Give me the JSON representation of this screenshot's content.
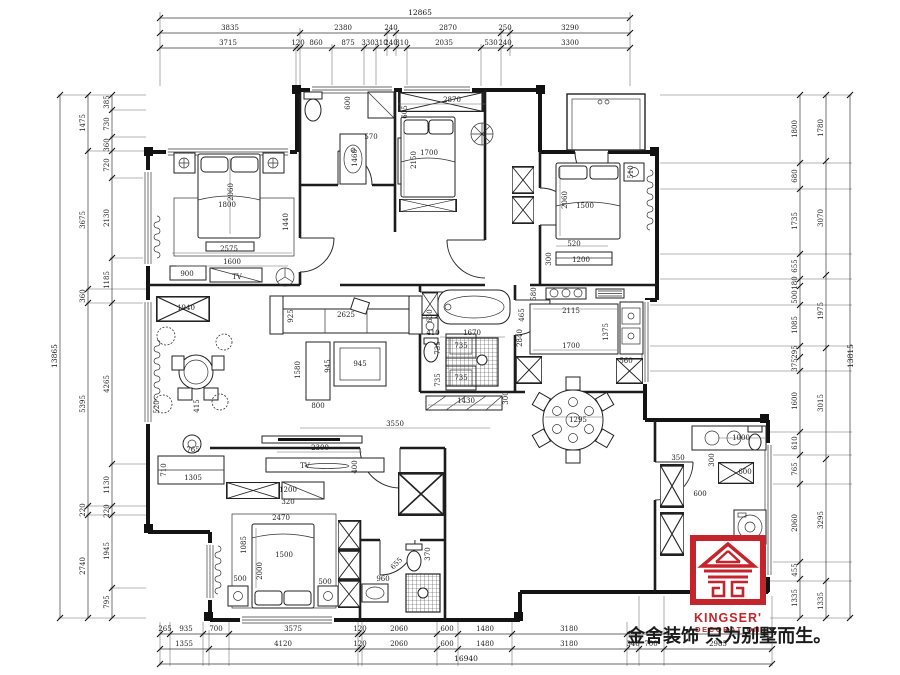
{
  "branding": {
    "logo_top": "KINGSER'",
    "logo_sub": "DECORATION",
    "slogan": "金舍装饰 只为别墅而生。"
  },
  "dims": {
    "top": {
      "total": "12865",
      "row2": [
        "3835",
        "2380",
        "240",
        "2870",
        "250",
        "3290"
      ],
      "row3": [
        "3715",
        "120",
        "860",
        "875",
        "330",
        "310",
        "240",
        "310",
        "2035",
        "530",
        "240",
        "3300"
      ]
    },
    "bottom": {
      "total": "16940",
      "row1": [
        "265",
        "935",
        "700",
        "3575",
        "120",
        "2060",
        "600",
        "1480",
        "3180"
      ],
      "row2": [
        "1355",
        "4120",
        "120",
        "2060",
        "600",
        "1480",
        "3180",
        "340",
        "700",
        "2985"
      ]
    },
    "left": {
      "total": "13865",
      "mid": [
        "1475",
        "3675",
        "360",
        "5395",
        "220",
        "2740"
      ],
      "inner": [
        "385",
        "730",
        "360",
        "720",
        "2130",
        "1185",
        "4265",
        "1130",
        "220",
        "1945",
        "795"
      ]
    },
    "right": {
      "total": "13815",
      "mid": [
        "1780",
        "3070",
        "1975",
        "3015",
        "3295",
        "1335"
      ],
      "inner": [
        "1800",
        "680",
        "1735",
        "655",
        "180",
        "500",
        "1085",
        "295",
        "375",
        "1600",
        "610",
        "765",
        "2060",
        "455",
        "1335"
      ]
    }
  },
  "plan": {
    "m_bed_l": "2060",
    "m_bed_w": "1800",
    "m_rug": "2575",
    "m_cab": "1600",
    "m_dresser": "900",
    "m_side": "1440",
    "m_tv": "TV",
    "wc_600": "600",
    "wc_570": "570",
    "wc_1460": "1460",
    "b2_ward": "2870",
    "b2_605": "605",
    "b2_bed": "1700",
    "b2_len": "2150",
    "b3_bed": "1500",
    "b3_len": "2060",
    "b3_520": "520",
    "b3_1200": "1200",
    "b3_300": "300",
    "b3_510": "510",
    "lv_1940": "1940",
    "lv_925": "925",
    "lv_sofa": "2625",
    "lv_630": "630",
    "lv_1580": "1580",
    "lv_800": "800",
    "lv_945v": "945",
    "lv_945h": "945",
    "lv_735a": "735",
    "lv_735b": "735",
    "lv_735c": "735",
    "lv_735d": "735",
    "lv_3550": "3550",
    "lv_2300": "2300",
    "lv_tv": "TV",
    "lv_400": "400",
    "dn_1305": "1305",
    "dn_710": "710",
    "dn_765": "765",
    "dn_520": "520",
    "dn_415": "415",
    "hb_410": "410",
    "hb_1670": "1670",
    "hb_1430": "1430",
    "hb_300": "300",
    "hb_2840": "2840",
    "k_580": "580",
    "k_465": "465",
    "k_2115": "2115",
    "k_1700": "1700",
    "k_560": "560",
    "k_1375": "1375",
    "dt_1295": "1295",
    "lb_1200": "1200",
    "lb_320": "320",
    "lb_2470": "2470",
    "lb_1085": "1085",
    "lb_bed": "1500",
    "lb_2000": "2000",
    "lb_500a": "500",
    "lb_500b": "500",
    "lb_960": "960",
    "lb_370": "370",
    "lb_655": "655",
    "br_350": "350",
    "br_1000": "1000",
    "br_300": "300",
    "br_600a": "600",
    "br_600b": "600"
  }
}
